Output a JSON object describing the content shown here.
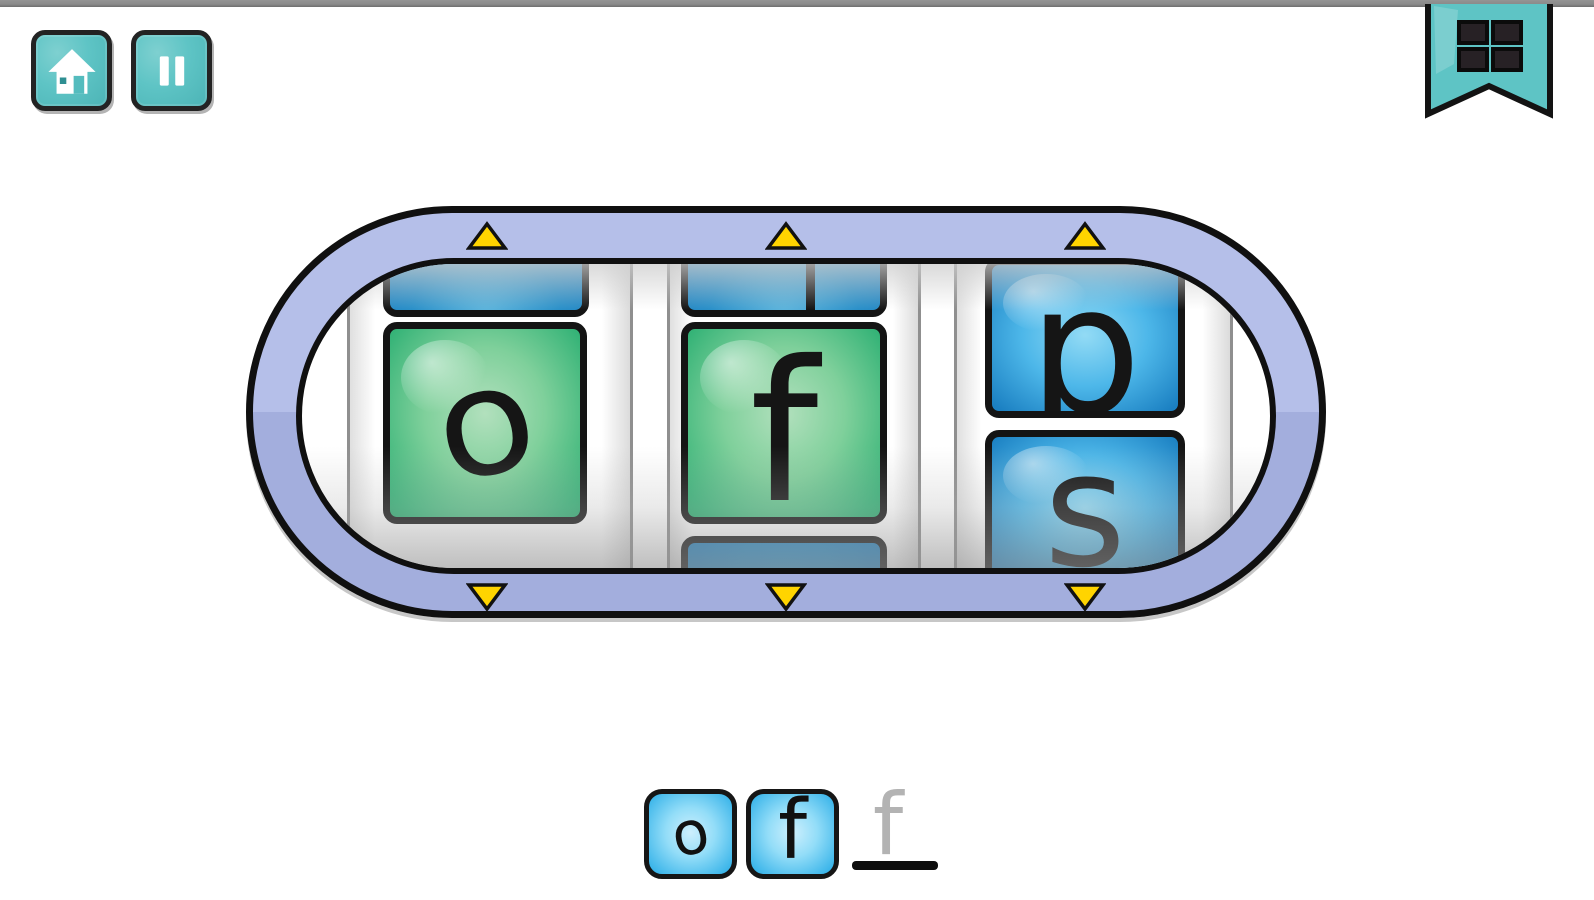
{
  "toolbar": {
    "home_button": {
      "icon": "home-icon"
    },
    "pause_button": {
      "icon": "pause-icon"
    }
  },
  "bookmark": {
    "icon": "grid-menu-icon"
  },
  "spinner": {
    "reels": [
      {
        "letter": "o",
        "tile_color": "green",
        "partial_tile_top": true
      },
      {
        "letter": "f",
        "tile_color": "green",
        "partial_tile_top": true,
        "partial_tile_bottom": true
      },
      {
        "letter_top": "p",
        "letter_bottom": "s",
        "tile_color": "blue"
      }
    ],
    "up_arrows": 3,
    "down_arrows": 3
  },
  "answer": {
    "tiles": [
      "o",
      "f"
    ],
    "hint_letter": "f"
  },
  "colors": {
    "teal_button": "#5ec4c5",
    "capsule_purple_top": "#b5bfe9",
    "capsule_purple_bottom": "#a3aedd",
    "green_tile": "#35b377",
    "blue_tile": "#2f9fd6",
    "answer_tile_blue": "#3db6ea",
    "arrow_yellow": "#ffd400",
    "top_bar_gray": "#8a8a8a",
    "outline_black": "#101010",
    "hint_gray": "#b3b3b3"
  }
}
